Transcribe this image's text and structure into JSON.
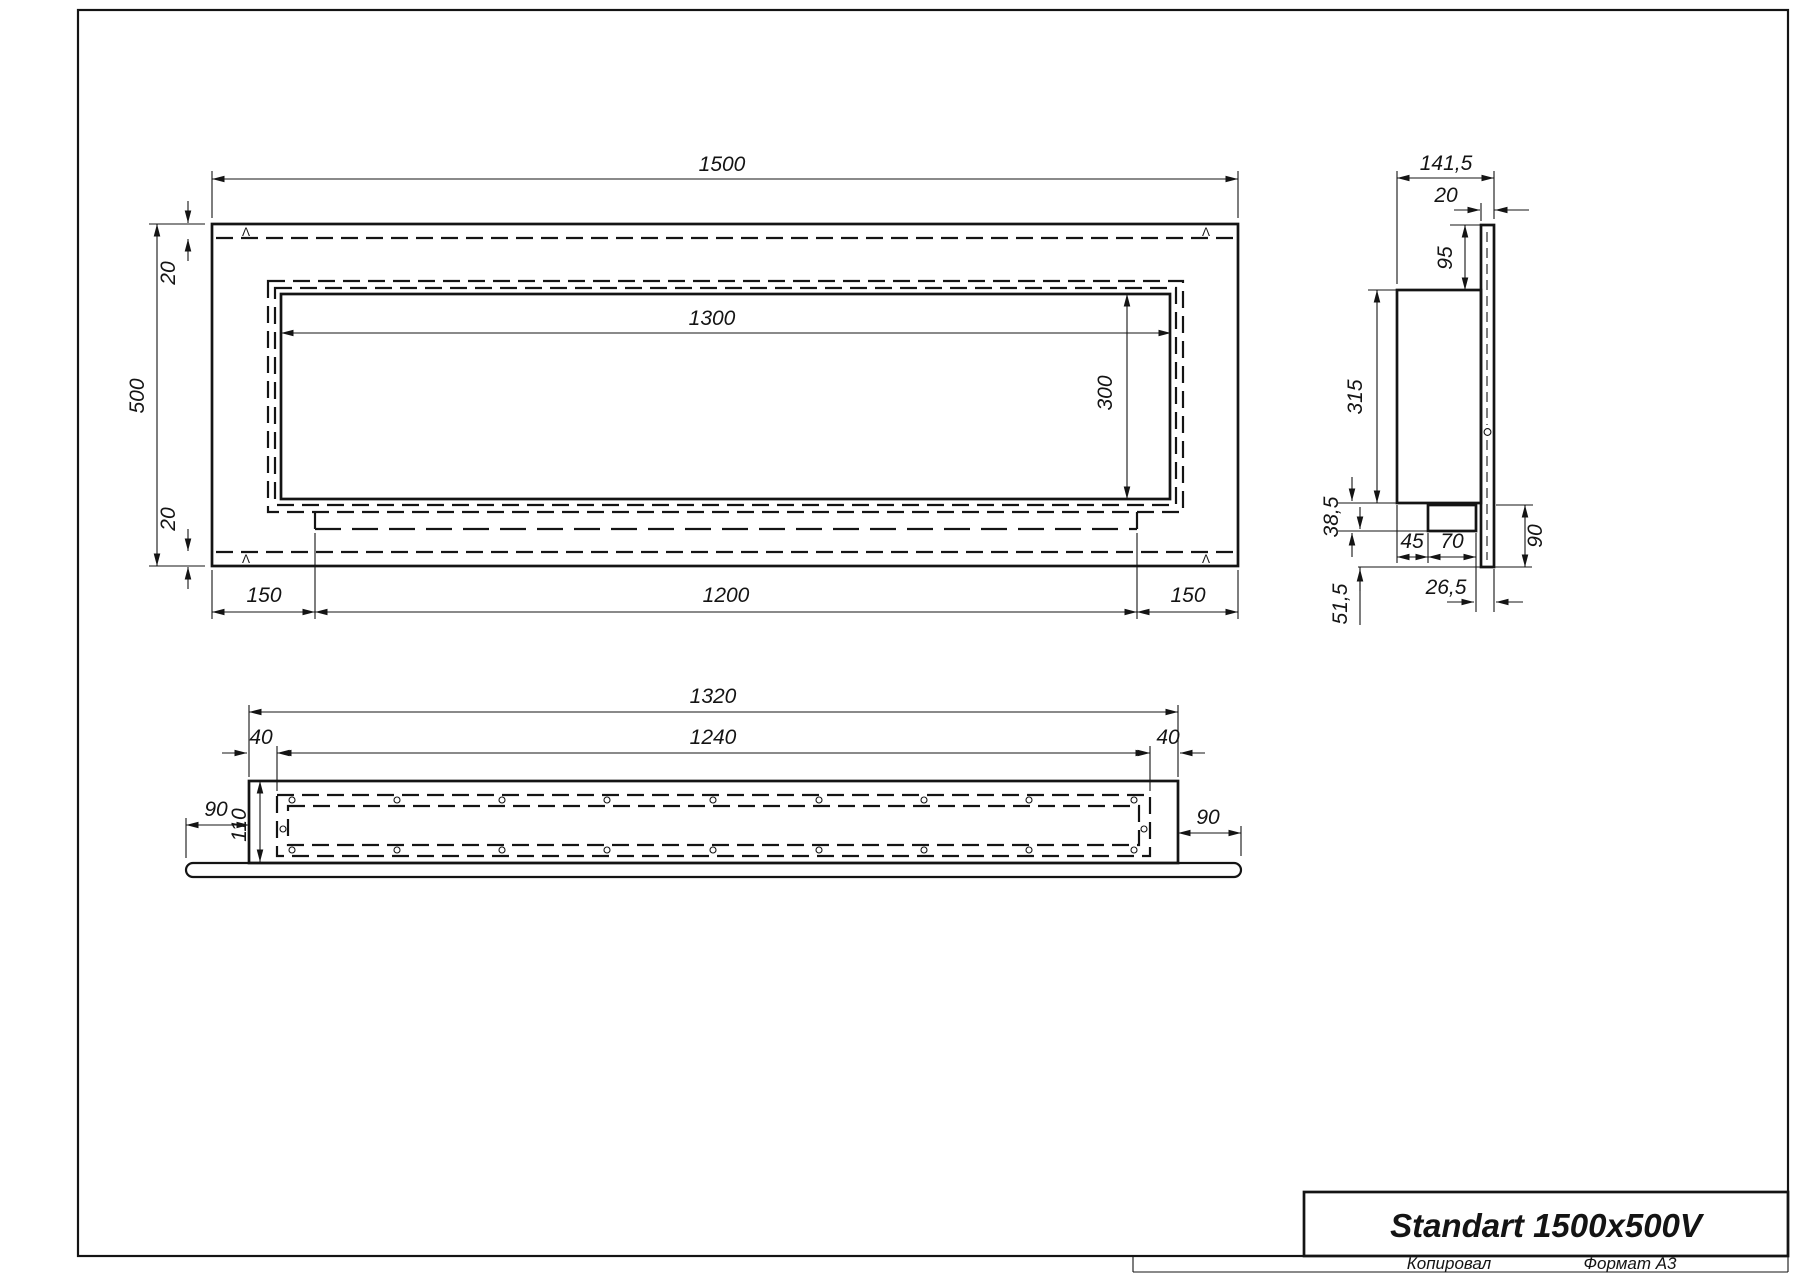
{
  "sheet": {
    "title": "Standart 1500x500V",
    "footer_copy": "Копировал",
    "footer_format": "Формат А3"
  },
  "marks": {
    "weld_glyph": "Λ"
  },
  "front_view": {
    "dims": {
      "width": "1500",
      "height": "500",
      "top_offset": "20",
      "bottom_offset": "20",
      "opening_width": "1300",
      "opening_height": "300",
      "left_margin": "150",
      "slot_width": "1200",
      "right_margin": "150"
    }
  },
  "side_view": {
    "dims": {
      "depth": "141,5",
      "flange": "20",
      "top_inset": "95",
      "body_height": "315",
      "step": "38,5",
      "lip_height": "51,5",
      "tray_offset": "45",
      "tray_width": "70",
      "drop": "90",
      "lip_depth": "26,5"
    }
  },
  "bottom_view": {
    "dims": {
      "overall": "1320",
      "slot": "1240",
      "inset_left": "40",
      "inset_right": "40",
      "ext_left": "90",
      "ext_right": "90",
      "depth": "110"
    }
  }
}
